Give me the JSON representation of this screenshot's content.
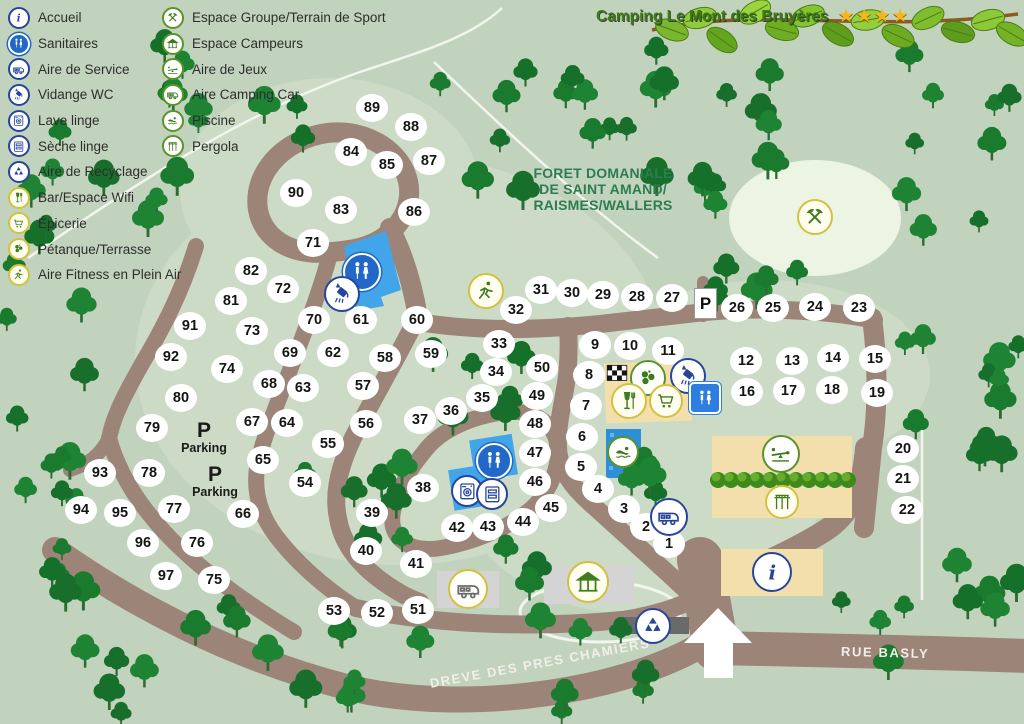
{
  "title": {
    "text": "Camping Le Mont des Bruyères",
    "stars": 4
  },
  "legend": {
    "column1": [
      {
        "icon": "info-icon",
        "sym": "info",
        "style": "blue",
        "label": "Accueil"
      },
      {
        "icon": "wc-icon",
        "sym": "wc",
        "style": "bluesolid",
        "label": "Sanitaires"
      },
      {
        "icon": "service-icon",
        "sym": "camper",
        "style": "blue",
        "label": "Aire de Service"
      },
      {
        "icon": "vidange-icon",
        "sym": "vidange",
        "style": "blue",
        "label": "Vidange WC"
      },
      {
        "icon": "washer-icon",
        "sym": "washer",
        "style": "blue",
        "label": "Lave linge"
      },
      {
        "icon": "dryer-icon",
        "sym": "dryer",
        "style": "blue",
        "label": "Sèche linge"
      },
      {
        "icon": "recycle-icon",
        "sym": "recycle",
        "style": "blue",
        "label": "Aire de Recyclage"
      },
      {
        "icon": "bar-wifi-icon",
        "sym": "bar",
        "style": "yellow",
        "label": "Bar/Espace Wifi"
      },
      {
        "icon": "cart-icon",
        "sym": "cart",
        "style": "yellow",
        "label": "Épicerie"
      },
      {
        "icon": "petanque-icon",
        "sym": "petanque",
        "style": "yellow",
        "label": "Pétanque/Terrasse"
      },
      {
        "icon": "fitness-icon",
        "sym": "fitness",
        "style": "yellow",
        "label": "Aire Fitness en Plein Air"
      }
    ],
    "column2": [
      {
        "icon": "tools-icon",
        "sym": "tools",
        "style": "green",
        "label": "Espace Groupe/Terrain de Sport"
      },
      {
        "icon": "gazebo-icon",
        "sym": "gazebo",
        "style": "green",
        "label": "Espace Campeurs"
      },
      {
        "icon": "playground-icon",
        "sym": "playground",
        "style": "green",
        "label": "Aire de Jeux"
      },
      {
        "icon": "camper-icon",
        "sym": "camper",
        "style": "green",
        "label": "Aire Camping Car"
      },
      {
        "icon": "swimmer-icon",
        "sym": "swimmer",
        "style": "green",
        "label": "Piscine"
      },
      {
        "icon": "pergola-icon",
        "sym": "pergola",
        "style": "green",
        "label": "Pergola"
      }
    ]
  },
  "forest_label": {
    "line1": "FORET DOMANIALE",
    "line2": "DE SAINT AMAND/",
    "line3": "RAISMES/WALLERS"
  },
  "roads": {
    "dreve": "DREVE DES PRES CHAMIERS",
    "rue": "RUE BASLY"
  },
  "parking": {
    "p": "P",
    "label": "Parking",
    "sign": "P",
    "spots": [
      {
        "x": 204,
        "y": 437
      },
      {
        "x": 215,
        "y": 481
      }
    ],
    "sign_pos": {
      "x": 705,
      "y": 303
    }
  },
  "pitches": [
    [
      1,
      669,
      544
    ],
    [
      2,
      646,
      527
    ],
    [
      3,
      624,
      509
    ],
    [
      4,
      598,
      489
    ],
    [
      5,
      581,
      467
    ],
    [
      6,
      582,
      437
    ],
    [
      7,
      586,
      406
    ],
    [
      8,
      589,
      375
    ],
    [
      9,
      595,
      345
    ],
    [
      10,
      630,
      346
    ],
    [
      11,
      668,
      351
    ],
    [
      12,
      746,
      361
    ],
    [
      13,
      792,
      361
    ],
    [
      14,
      833,
      358
    ],
    [
      15,
      875,
      359
    ],
    [
      16,
      747,
      392
    ],
    [
      17,
      789,
      391
    ],
    [
      18,
      832,
      390
    ],
    [
      19,
      877,
      393
    ],
    [
      20,
      903,
      449
    ],
    [
      21,
      903,
      479
    ],
    [
      22,
      907,
      510
    ],
    [
      23,
      859,
      308
    ],
    [
      24,
      815,
      307
    ],
    [
      25,
      773,
      308
    ],
    [
      26,
      737,
      308
    ],
    [
      27,
      672,
      298
    ],
    [
      28,
      637,
      297
    ],
    [
      29,
      603,
      295
    ],
    [
      30,
      572,
      293
    ],
    [
      31,
      541,
      290
    ],
    [
      32,
      516,
      310
    ],
    [
      33,
      499,
      344
    ],
    [
      34,
      496,
      372
    ],
    [
      35,
      482,
      398
    ],
    [
      36,
      451,
      411
    ],
    [
      37,
      420,
      420
    ],
    [
      38,
      423,
      488
    ],
    [
      39,
      372,
      513
    ],
    [
      40,
      366,
      551
    ],
    [
      41,
      416,
      564
    ],
    [
      42,
      457,
      528
    ],
    [
      43,
      488,
      527
    ],
    [
      44,
      523,
      522
    ],
    [
      45,
      551,
      508
    ],
    [
      46,
      535,
      482
    ],
    [
      47,
      535,
      453
    ],
    [
      48,
      535,
      424
    ],
    [
      49,
      537,
      396
    ],
    [
      50,
      542,
      368
    ],
    [
      51,
      418,
      610
    ],
    [
      52,
      377,
      613
    ],
    [
      53,
      334,
      611
    ],
    [
      54,
      305,
      483
    ],
    [
      55,
      328,
      444
    ],
    [
      56,
      366,
      424
    ],
    [
      57,
      363,
      386
    ],
    [
      58,
      385,
      358
    ],
    [
      59,
      431,
      354
    ],
    [
      60,
      417,
      320
    ],
    [
      61,
      361,
      320
    ],
    [
      62,
      333,
      353
    ],
    [
      63,
      303,
      388
    ],
    [
      64,
      287,
      423
    ],
    [
      65,
      263,
      460
    ],
    [
      66,
      243,
      514
    ],
    [
      67,
      252,
      422
    ],
    [
      68,
      269,
      384
    ],
    [
      69,
      290,
      353
    ],
    [
      70,
      314,
      320
    ],
    [
      71,
      313,
      243
    ],
    [
      72,
      283,
      289
    ],
    [
      73,
      252,
      331
    ],
    [
      74,
      227,
      369
    ],
    [
      75,
      214,
      580
    ],
    [
      76,
      197,
      543
    ],
    [
      77,
      174,
      509
    ],
    [
      78,
      149,
      473
    ],
    [
      79,
      152,
      428
    ],
    [
      80,
      181,
      398
    ],
    [
      81,
      231,
      301
    ],
    [
      82,
      251,
      271
    ],
    [
      83,
      341,
      210
    ],
    [
      84,
      351,
      152
    ],
    [
      85,
      387,
      165
    ],
    [
      86,
      414,
      212
    ],
    [
      87,
      429,
      161
    ],
    [
      88,
      411,
      127
    ],
    [
      89,
      372,
      108
    ],
    [
      90,
      296,
      193
    ],
    [
      91,
      190,
      326
    ],
    [
      92,
      171,
      357
    ],
    [
      93,
      100,
      473
    ],
    [
      94,
      81,
      510
    ],
    [
      95,
      120,
      513
    ],
    [
      96,
      143,
      543
    ],
    [
      97,
      166,
      576
    ]
  ],
  "map_icons": [
    {
      "name": "sanitaires-pool-icon",
      "sym": "wc",
      "style": "bluesolid",
      "x": 362,
      "y": 272,
      "s": 38
    },
    {
      "name": "vidange-pool-icon",
      "sym": "vidange",
      "style": "blue",
      "x": 342,
      "y": 294,
      "s": 36
    },
    {
      "name": "fitness-area-icon",
      "sym": "fitness",
      "style": "yellow",
      "x": 486,
      "y": 291,
      "s": 36
    },
    {
      "name": "race-flag-icon",
      "sym": "flag",
      "style": "flag",
      "x": 617,
      "y": 374,
      "s": 26
    },
    {
      "name": "petanque-area-icon",
      "sym": "petanque",
      "style": "green",
      "x": 648,
      "y": 378,
      "s": 36
    },
    {
      "name": "vidange-area-icon",
      "sym": "vidange",
      "style": "blue",
      "x": 688,
      "y": 376,
      "s": 36
    },
    {
      "name": "bar-area-icon",
      "sym": "bar",
      "style": "yellow",
      "x": 629,
      "y": 401,
      "s": 36
    },
    {
      "name": "epicerie-area-icon",
      "sym": "cart",
      "style": "yellow",
      "x": 666,
      "y": 401,
      "s": 34
    },
    {
      "name": "sanitaires-east-icon",
      "sym": "wc",
      "style": "bluesq",
      "x": 705,
      "y": 398,
      "s": 32
    },
    {
      "name": "piscine-icon",
      "sym": "swimmer",
      "style": "green",
      "x": 623,
      "y": 452,
      "s": 32
    },
    {
      "name": "aire-service-icon",
      "sym": "camper",
      "style": "blue",
      "x": 669,
      "y": 517,
      "s": 38
    },
    {
      "name": "espace-groupe-icon",
      "sym": "tools",
      "style": "yellow",
      "x": 815,
      "y": 217,
      "s": 36
    },
    {
      "name": "aire-jeux-icon",
      "sym": "playground",
      "style": "green",
      "x": 781,
      "y": 454,
      "s": 38
    },
    {
      "name": "pergola-area-icon",
      "sym": "pergola",
      "style": "yellow",
      "x": 782,
      "y": 502,
      "s": 34
    },
    {
      "name": "accueil-info-icon",
      "sym": "info",
      "style": "blue",
      "x": 772,
      "y": 572,
      "s": 40
    },
    {
      "name": "sanitaires-south-icon",
      "sym": "wc",
      "style": "bluesolid",
      "x": 494,
      "y": 461,
      "s": 36
    },
    {
      "name": "lave-linge-icon",
      "sym": "washer",
      "style": "blue",
      "x": 467,
      "y": 491,
      "s": 32
    },
    {
      "name": "seche-linge-icon",
      "sym": "dryer",
      "style": "blue",
      "x": 492,
      "y": 494,
      "s": 32
    },
    {
      "name": "aire-camping-car-icon",
      "sym": "camper",
      "style": "yellowgrey",
      "x": 468,
      "y": 589,
      "s": 40
    },
    {
      "name": "espace-campeurs-icon",
      "sym": "gazebo",
      "style": "yellow",
      "x": 588,
      "y": 582,
      "s": 42
    },
    {
      "name": "recyclage-icon",
      "sym": "recycle",
      "style": "blue",
      "x": 653,
      "y": 626,
      "s": 36
    }
  ],
  "colors": {
    "background": "#c2d3bd",
    "road": "#9c8478",
    "tree": "#1a7a2e",
    "water": "#42a5e9",
    "building_beige": "#f3dfab",
    "building_grey": "#d4d4d4",
    "star": "#f3b71d"
  }
}
